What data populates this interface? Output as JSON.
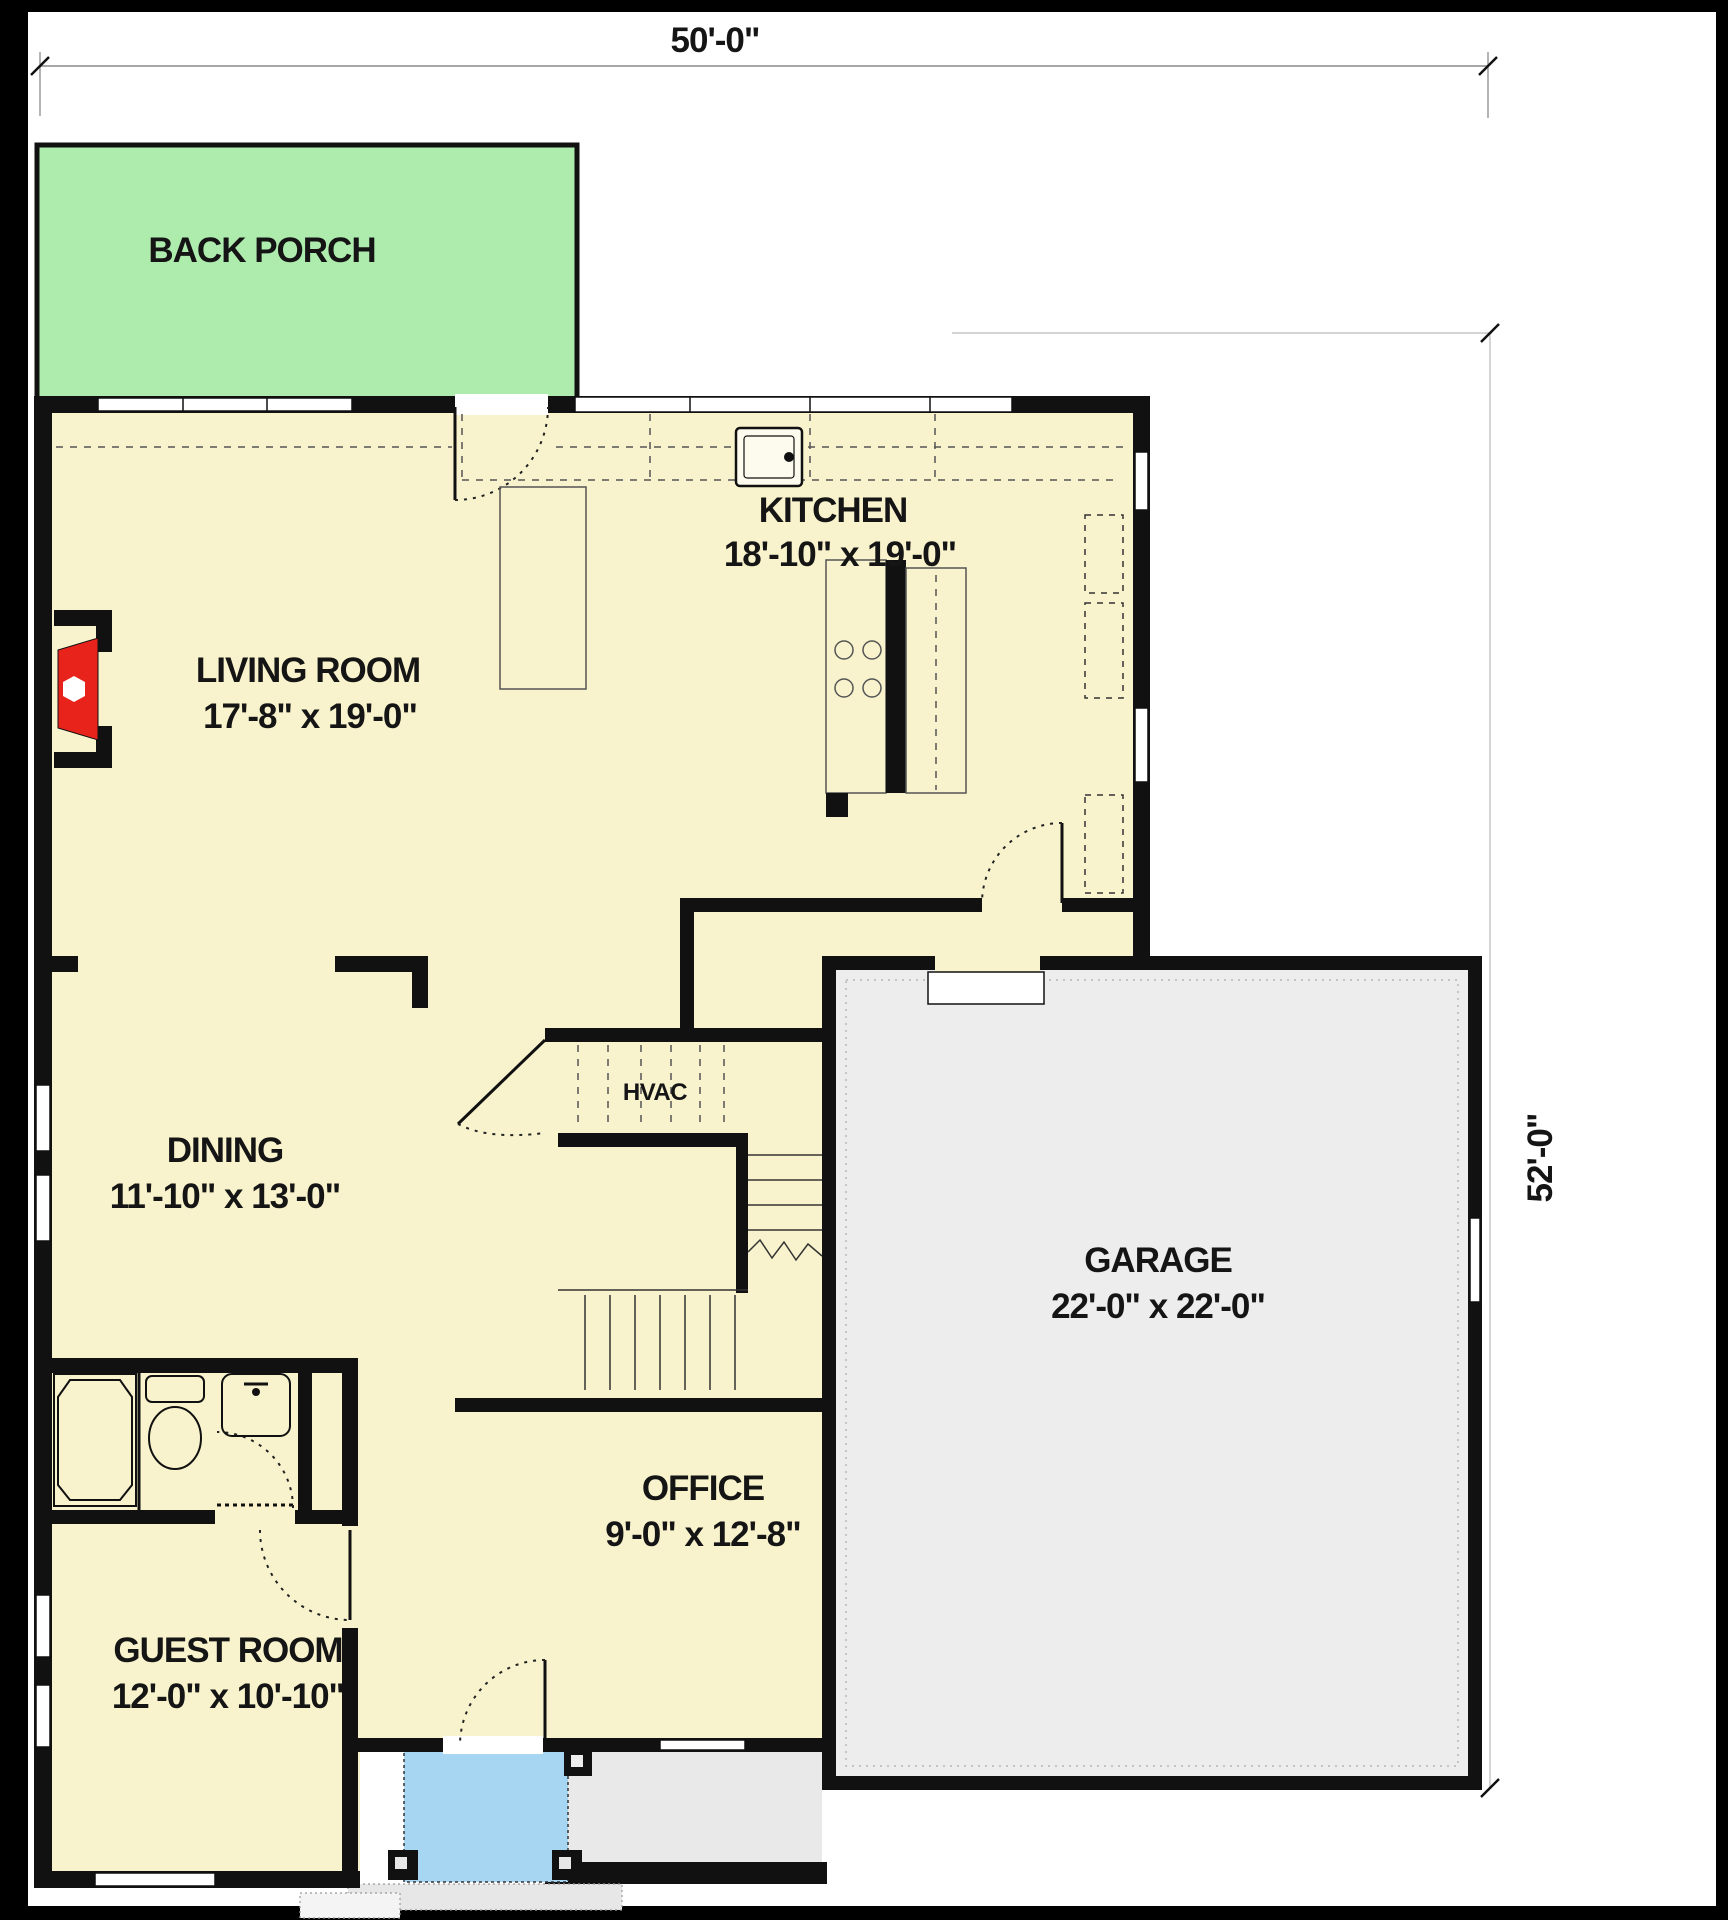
{
  "dims": {
    "width": "50'-0\"",
    "height": "52'-0\""
  },
  "rooms": {
    "back_porch": {
      "name": "BACK PORCH"
    },
    "living": {
      "name": "LIVING ROOM",
      "size": "17'-8\" x 19'-0\""
    },
    "kitchen": {
      "name": "KITCHEN",
      "size": "18'-10\" x 19'-0\""
    },
    "dining": {
      "name": "DINING",
      "size": "11'-10\" x 13'-0\""
    },
    "garage": {
      "name": "GARAGE",
      "size": "22'-0\" x 22'-0\""
    },
    "office": {
      "name": "OFFICE",
      "size": "9'-0\" x 12'-8\""
    },
    "guest": {
      "name": "GUEST ROOM",
      "size": "12'-0\" x 10'-10\""
    },
    "hvac": {
      "name": "HVAC"
    }
  },
  "colors": {
    "floor": "#f8f3cc",
    "back_porch": "#aeecae",
    "front_porch": "#a6d6f2",
    "garage_floor": "#ededed",
    "walk": "#e9e9e9",
    "fireplace": "#e8231c",
    "wall": "#111111"
  }
}
